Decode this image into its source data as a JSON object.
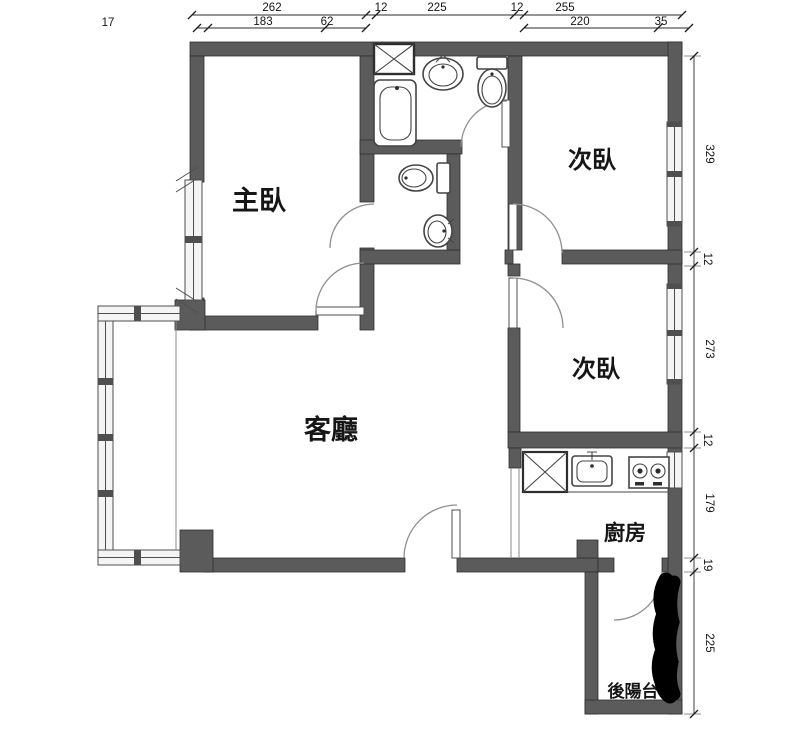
{
  "drawing": {
    "type": "apartment-floor-plan",
    "background": "#ffffff"
  },
  "rooms": {
    "master_bedroom": {
      "label": "主臥"
    },
    "bedroom_top_right": {
      "label": "次臥"
    },
    "bedroom_mid_right": {
      "label": "次臥"
    },
    "living_room": {
      "label": "客廳"
    },
    "kitchen": {
      "label": "廚房"
    },
    "back_balcony": {
      "label": "後陽台"
    }
  },
  "dimensions": {
    "top_primary": [
      "262",
      "12",
      "225",
      "12",
      "255"
    ],
    "top_secondary": [
      "17",
      "183",
      "62",
      "220",
      "35"
    ],
    "right_side": [
      "329",
      "12",
      "273",
      "12",
      "179",
      "19",
      "225"
    ]
  },
  "fixtures": {
    "bathtub": "bathtub-icon",
    "washbasin_main": "round-washbasin-icon",
    "toilet_main": "toilet-icon",
    "toilet_ensuite": "toilet-icon",
    "washbasin_ensuite": "round-washbasin-icon",
    "duct_shaft": "x-box-shaft-icon",
    "kitchen_cabinet": "x-box-cabinet-icon",
    "kitchen_sink": "kitchen-sink-icon",
    "stove": "two-burner-stove-icon",
    "redaction_mark": "black-marker-scribble"
  },
  "colors": {
    "wall": "#5b5b5b",
    "wall_outline": "#2f2f2f",
    "window_fill": "#f4f4f4",
    "fixture_line": "#454545",
    "door_arc": "#8f8f8f",
    "dimension_text": "#141414",
    "redaction": "#000000"
  }
}
